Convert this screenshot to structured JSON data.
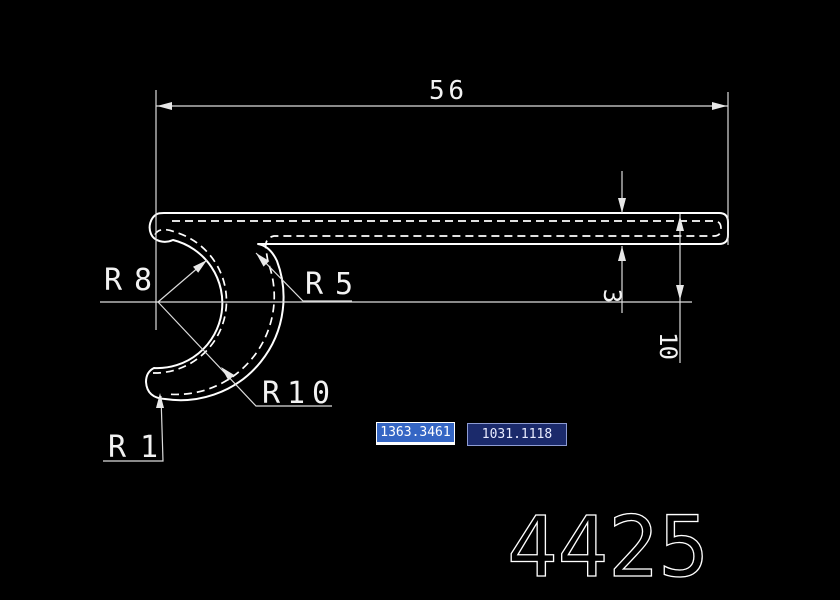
{
  "drawing": {
    "dim_width": "56",
    "dim_thickness": "3",
    "dim_offset": "10",
    "r_inner": "R8",
    "r_corner": "R5",
    "r_outer": "R10",
    "r_tip": "R1",
    "part_number": "4425"
  },
  "dynamic_input": {
    "x_value": "1363.3461",
    "y_value": "1031.1118"
  },
  "colors": {
    "background": "#000000",
    "profile_line": "#ffffff",
    "dimension_line": "#dcdcdc",
    "selected_field_bg": "#3566c4",
    "field_bg": "#1b2a6b",
    "field_border": "#8d9bd3"
  }
}
